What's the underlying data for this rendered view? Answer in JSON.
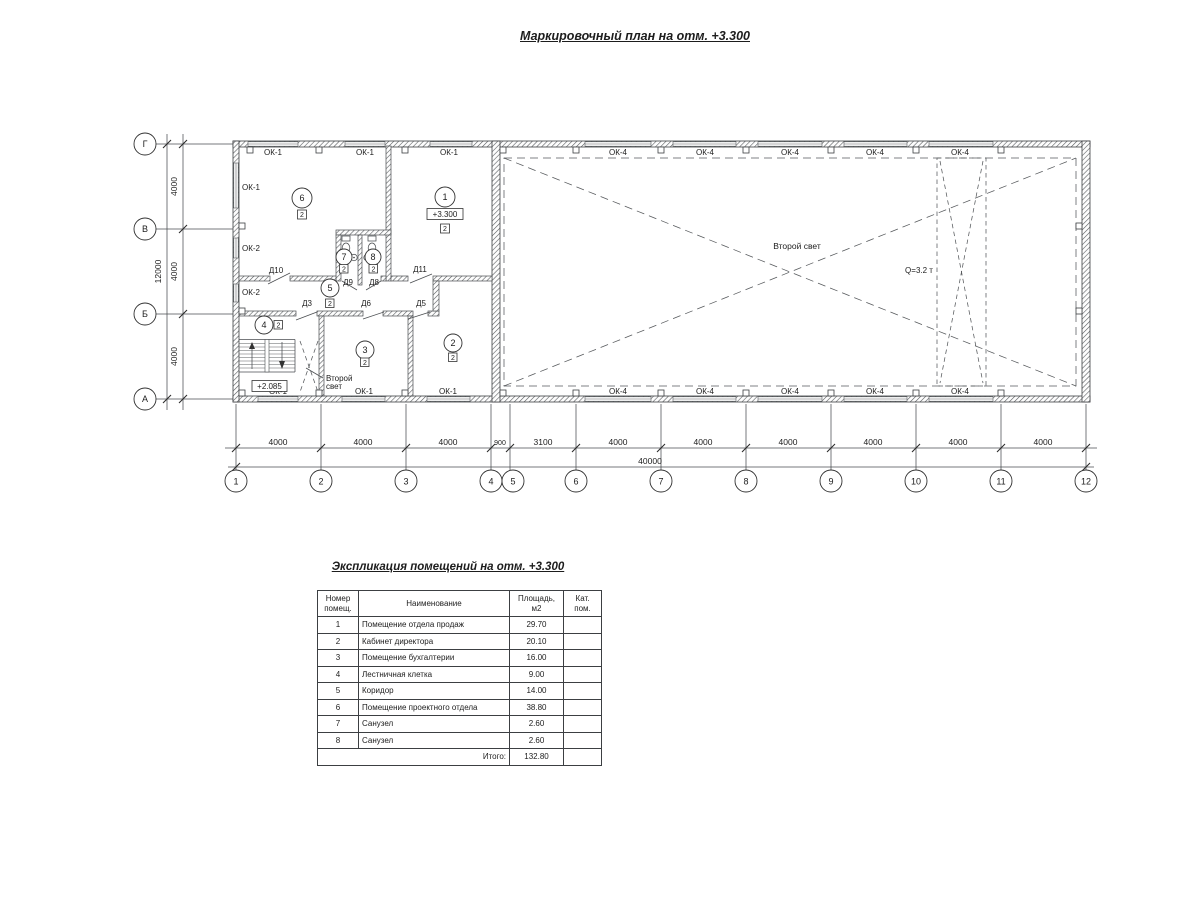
{
  "page": {
    "title": "Маркировочный план на отм. +3.300"
  },
  "plan": {
    "axes_bottom": [
      "1",
      "2",
      "3",
      "4",
      "5",
      "6",
      "7",
      "8",
      "9",
      "10",
      "11",
      "12"
    ],
    "axes_left": [
      "Г",
      "В",
      "Б",
      "А"
    ],
    "dims_bottom": [
      "4000",
      "4000",
      "4000",
      "900",
      "3100",
      "4000",
      "4000",
      "4000",
      "4000",
      "4000",
      "4000"
    ],
    "dim_total_bottom": "40000",
    "dims_left": [
      "4000",
      "4000",
      "4000"
    ],
    "dim_total_left": "12000",
    "win": {
      "ok1_top": [
        "ОК-1",
        "ОК-1",
        "ОК-1"
      ],
      "ok1_bottom": [
        "ОК-1",
        "ОК-1",
        "ОК-1"
      ],
      "left": [
        "ОК-1",
        "ОК-2",
        "ОК-2"
      ],
      "ok4_top": [
        "ОК-4",
        "ОК-4",
        "ОК-4",
        "ОК-4",
        "ОК-4"
      ],
      "ok4_bottom": [
        "ОК-4",
        "ОК-4",
        "ОК-4",
        "ОК-4",
        "ОК-4"
      ]
    },
    "doors": {
      "d10": "Д10",
      "d9": "Д9",
      "d8": "Д8",
      "d11": "Д11",
      "d3": "Д3",
      "d6": "Д6",
      "d5": "Д5"
    },
    "rooms": {
      "r1": "1",
      "r2": "2",
      "r3": "3",
      "r4": "4",
      "r5": "5",
      "r6": "6",
      "r7": "7",
      "r8": "8"
    },
    "category": "2",
    "elevations": {
      "main": "+3.300",
      "stair": "+2.085"
    },
    "notes": {
      "hall": "Второй свет",
      "stair_l1": "Второй",
      "stair_l2": "свет",
      "crane": "Q=3.2 т"
    }
  },
  "schedule": {
    "title": "Экспликация помещений на отм. +3.300",
    "headers": {
      "num": "Номер\nпомещ.",
      "name": "Наименование",
      "area": "Площадь,\nм2",
      "cat": "Кат.\nпом."
    },
    "rows": [
      {
        "num": "1",
        "name": "Помещение отдела продаж",
        "area": "29.70",
        "cat": ""
      },
      {
        "num": "2",
        "name": "Кабинет директора",
        "area": "20.10",
        "cat": ""
      },
      {
        "num": "3",
        "name": "Помещение бухгалтерии",
        "area": "16.00",
        "cat": ""
      },
      {
        "num": "4",
        "name": "Лестничная клетка",
        "area": "9.00",
        "cat": ""
      },
      {
        "num": "5",
        "name": "Коридор",
        "area": "14.00",
        "cat": ""
      },
      {
        "num": "6",
        "name": "Помещение проектного отдела",
        "area": "38.80",
        "cat": ""
      },
      {
        "num": "7",
        "name": "Санузел",
        "area": "2.60",
        "cat": ""
      },
      {
        "num": "8",
        "name": "Санузел",
        "area": "2.60",
        "cat": ""
      }
    ],
    "total_label": "Итого:",
    "total_value": "132.80"
  }
}
